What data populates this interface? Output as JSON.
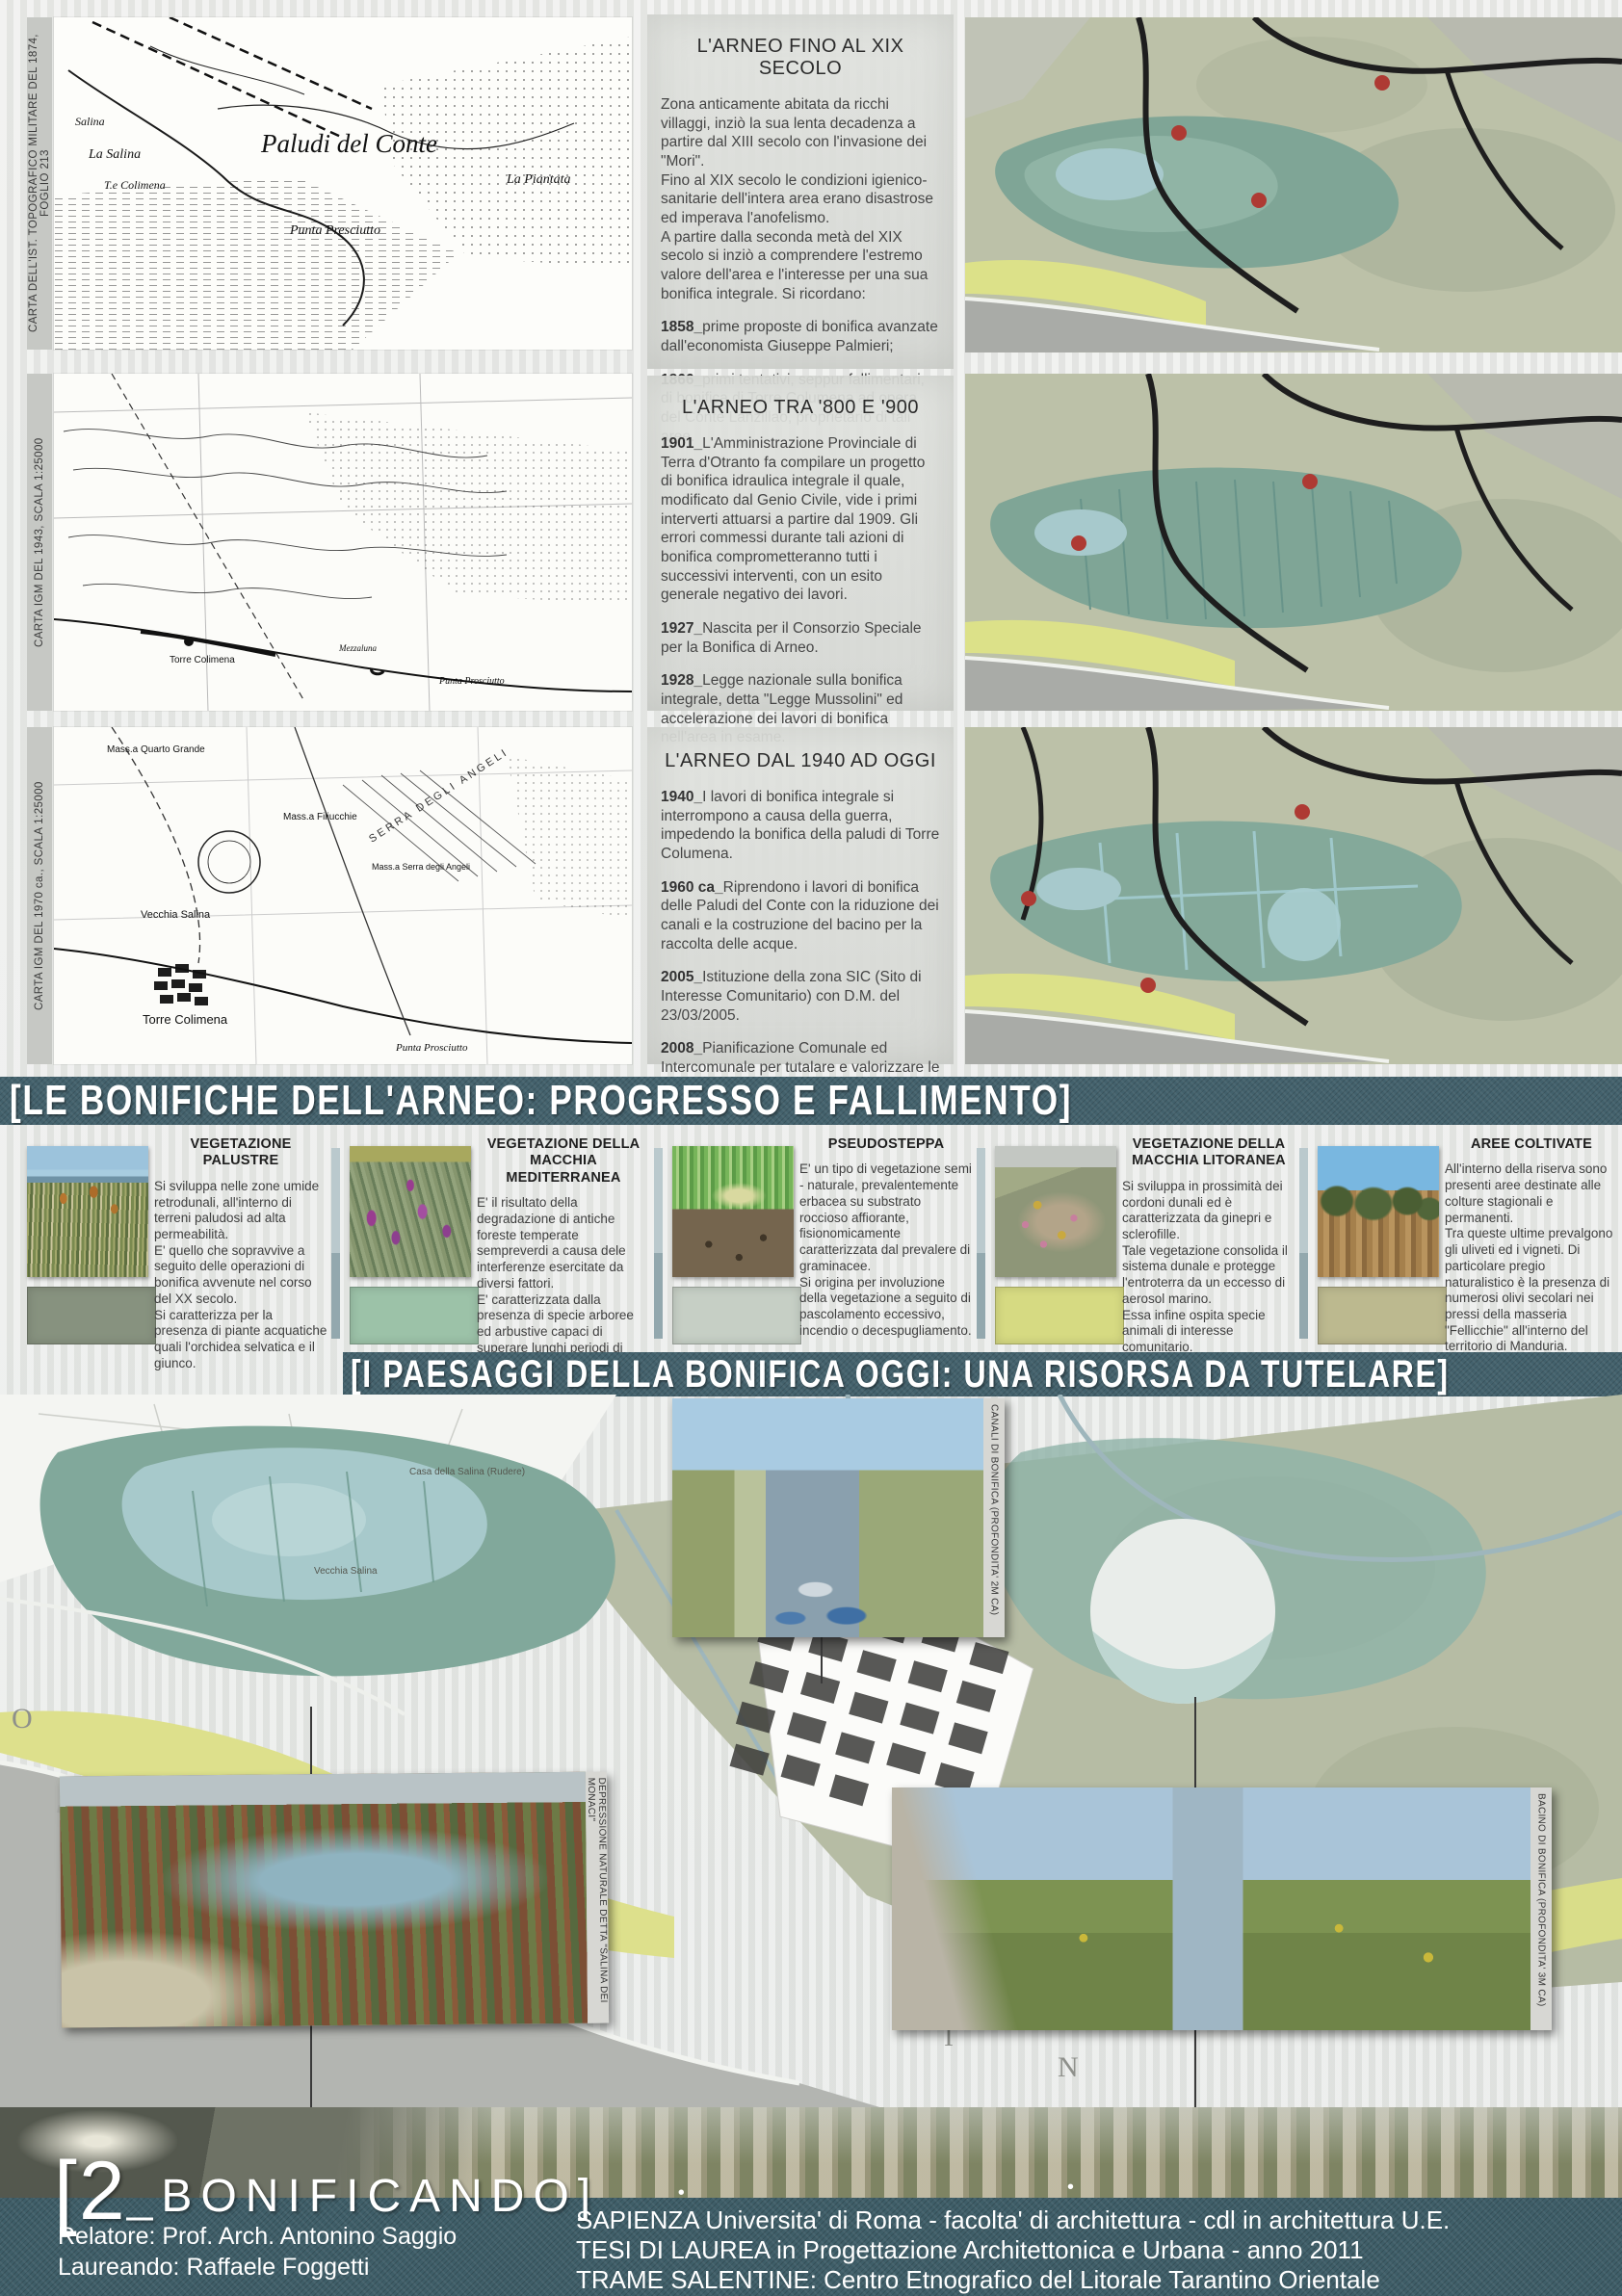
{
  "rows": [
    {
      "caption": "CARTA DELL'IST. TOPOGRAFICO MILITARE DEL 1874, FOGLIO 213",
      "heading": "L'ARNEO FINO AL XIX SECOLO",
      "intro": "Zona anticamente abitata da ricchi villaggi, inziò la sua lenta decadenza a partire dal XIII secolo con l'invasione dei \"Mori\".\nFino al XIX secolo le condizioni igienico-sanitarie dell'intera area erano disastrose ed imperava l'anofelismo.\nA partire dalla seconda metà del XIX secolo si inziò a comprendere l'estremo valore dell'area e l'interesse per una sua bonifica integrale. Si ricordano:",
      "entries": [
        {
          "y": "1858_",
          "t": "prime proposte di bonifica avanzate dall'economista Giuseppe Palmieri;"
        },
        {
          "y": "1866_",
          "t": "primi tentativi, seppur fallimentari, di bonifica di Torre Columena ad opera del Conte Lanzillao, proprietario di tali aree."
        }
      ],
      "labels": [
        "Salina",
        "La Salina",
        "T.e Colimena",
        "Paludi del Conte",
        "La Piantata",
        "Punta Presciutto"
      ]
    },
    {
      "caption": "CARTA IGM DEL 1943, SCALA 1:25000",
      "heading": "L'ARNEO TRA '800 E '900",
      "entries": [
        {
          "y": "1901_",
          "t": "L'Amministrazione Provinciale di Terra d'Otranto fa compilare un progetto di bonifica idraulica integrale il quale, modificato dal Genio Civile, vide i primi interverti attuarsi a partire dal 1909. Gli errori commessi durante tali azioni di bonifica comprometteranno tutti i successivi interventi, con un esito generale negativo dei lavori."
        },
        {
          "y": "1927_",
          "t": "Nascita per il Consorzio Speciale per la Bonifica di Arneo."
        },
        {
          "y": "1928_",
          "t": "Legge nazionale sulla bonifica integrale, detta \"Legge Mussolini\" ed accelerazione dei lavori di bonifica nell'area in esame."
        }
      ],
      "labels": [
        "Torre Colimena",
        "Mezzaluna",
        "Punta Prosciutto"
      ]
    },
    {
      "caption": "CARTA IGM DEL 1970 ca., SCALA 1:25000",
      "heading": "L'ARNEO DAL 1940 AD OGGI",
      "entries": [
        {
          "y": "1940_",
          "t": "I lavori di bonifica integrale si interrompono a causa della guerra, impedendo la bonifica della paludi di Torre Columena."
        },
        {
          "y": "1960 ca_",
          "t": "Riprendono i lavori di bonifica delle Paludi del Conte con la riduzione dei canali e la costruzione del bacino per la raccolta delle acque."
        },
        {
          "y": "2005_",
          "t": "Istituzione della zona SIC (Sito di Interesse Comunitario) con D.M. del 23/03/2005."
        },
        {
          "y": "2008_",
          "t": "Pianificazione Comunale ed Intercomunale per tutalare e valorizzare le riserve naturali regionali orientate ed ipotesi di connessione tra le stesse."
        }
      ],
      "labels": [
        "Mass.a Quarto Grande",
        "Mass.a Filiucchie",
        "SERRA DEGLI ANGELI",
        "Mass.a Serra degli Angeli",
        "Vecchia Salina",
        "Torre Colimena",
        "Punta Prosciutto"
      ]
    }
  ],
  "banners": {
    "reclamation": "[LE BONIFICHE DELL'ARNEO: PROGRESSO E FALLIMENTO]",
    "landscapes": "[I PAESAGGI DELLA BONIFICA OGGI: UNA RISORSA DA TUTELARE]"
  },
  "vegetation": [
    {
      "title": "VEGETAZIONE PALUSTRE",
      "text": "Si sviluppa nelle zone umide retrodunali, all'interno di terreni paludosi ad alta permeabilità.\nE' quello che sopravvive a seguito delle operazioni di bonifica avvenute nel corso del XX secolo.\nSi caratterizza per la presenza di piante acquatiche quali l'orchidea selvatica e il giunco.",
      "swatch": "#87927f",
      "swatch_css": "background:#87927f"
    },
    {
      "title": "VEGETAZIONE DELLA MACCHIA MEDITERRANEA",
      "text": "E' il risultato della degradazione di antiche foreste temperate sempreverdi a causa dele interferenze esercitate da diversi fattori.\nE' caratterizzata dalla presenza di specie arboree ed arbustive capaci di superare lunghi periodi di siccità con temperature elevate.",
      "swatch": "#9cc2a8",
      "swatch_css": "background:#9cc2a8"
    },
    {
      "title": "PSEUDOSTEPPA",
      "text": "E' un tipo di vegetazione semi - naturale, prevalentemente erbacea su substrato roccioso affiorante, fisionomicamente caratterizzata dal prevalere di graminacee.\nSi origina per involuzione della vegetazione a seguito di pascolamento eccessivo, incendio o decespugliamento.",
      "swatch": "#c6cfc5",
      "swatch_css": "background:#c6cfc5"
    },
    {
      "title": "VEGETAZIONE DELLA MACCHIA LITORANEA",
      "text": "Si sviluppa in prossimità dei cordoni dunali ed è caratterizzata da ginepri e sclerofille.\nTale vegetazione consolida il sistema dunale e protegge l'entroterra da un eccesso di aerosol marino.\nEssa infine ospita specie animali di interesse comunitario.",
      "swatch": "#d6da82",
      "swatch_css": "background:#d6da82"
    },
    {
      "title": "AREE COLTIVATE",
      "text": "All'interno della riserva sono presenti aree destinate alle colture stagionali e permanenti.\nTra queste ultime prevalgono gli uliveti ed i vigneti. Di particolare pregio naturalistico è la presenza di numerosi olivi secolari nei pressi della masseria \"Fellicchie\" all'interno del territorio di Manduria.",
      "swatch": "#bcb98f",
      "swatch_css": "background:#bcb98f"
    }
  ],
  "big_map": {
    "photo_captions": [
      "CANALI DI BONIFICA (PROFONDITA' 2M CA)",
      "DEPRESSIONE NATURALE DETTA \"SALINA DEI MONACI\"",
      "BACINO DI BONIFICA (PROFONDITA' 3M CA)"
    ],
    "labels": {
      "casa": "Casa della Salina (Rudere)",
      "vecchia": "Vecchia Salina"
    },
    "sea_letters": [
      "O",
      "I",
      "N"
    ]
  },
  "footer": {
    "title_bracket": "[2",
    "title_rest": "_BONIFICANDO]",
    "relatore": "Relatore: Prof. Arch. Antonino Saggio",
    "laureando": "Laureando: Raffaele Foggetti",
    "line1": "SAPIENZA Universita' di Roma - facolta' di architettura - cdl in architettura U.E.",
    "line2": "TESI DI LAUREA in Progettazione Architettonica e Urbana - anno 2011",
    "line3": "TRAME SALENTINE: Centro Etnografico del Litorale Tarantino Orientale"
  }
}
